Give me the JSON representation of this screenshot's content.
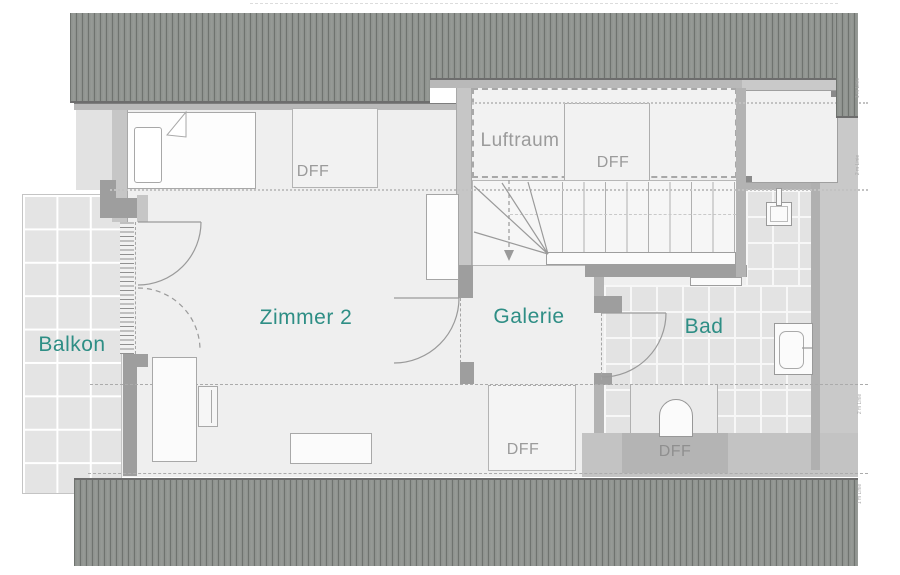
{
  "plan": {
    "type": "floor-plan",
    "colors": {
      "room_label_teal": "#2e8e85",
      "secondary_label_gray": "#9b9b9b",
      "roof_hatch_gray": "#8e928e",
      "wall_dark": "#9e9e9e",
      "wall_light": "#c6c6c6",
      "tile_gray": "#e3e3e3"
    }
  },
  "rooms": {
    "balkon": {
      "label": "Balkon"
    },
    "zimmer2": {
      "label": "Zimmer 2"
    },
    "galerie": {
      "label": "Galerie"
    },
    "bad": {
      "label": "Bad"
    },
    "luftraum": {
      "label": "Luftraum"
    }
  },
  "windows": {
    "dff": "DFF"
  },
  "height_labels": {
    "one_m": "1 m Linie",
    "two_m": "2 m Linie"
  },
  "features": {
    "stairs": "stairs-with-winders",
    "stair_direction": "down-arrow",
    "fixtures": [
      "bed",
      "desk",
      "chair",
      "table",
      "cupboard",
      "sink",
      "washbasin",
      "toilet",
      "shelf"
    ]
  }
}
